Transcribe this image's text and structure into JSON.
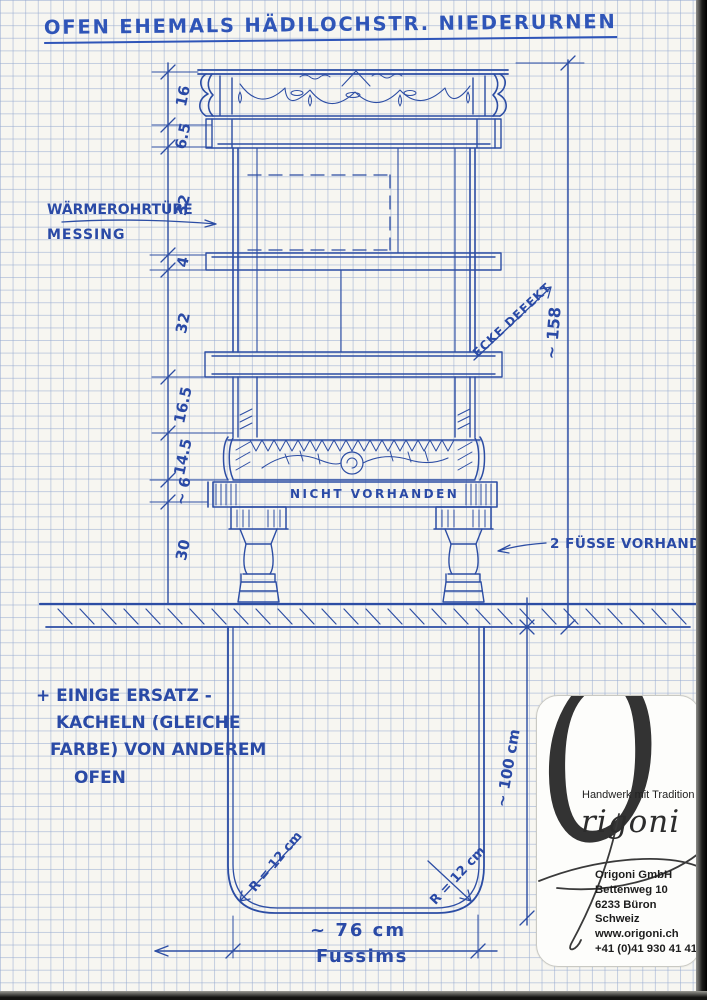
{
  "title": "OFEN EHEMALS HÄDILOCHSTR. NIEDERURNEN",
  "labels": {
    "door_line1": "WÄRMEROHRTÜRE",
    "door_line2": "MESSING",
    "corner_defect": "ECKE DEFEKT",
    "not_present": "NICHT VORHANDEN",
    "feet": "2 FÜSSE VORHANDEN",
    "note1": "+ EINIGE ERSATZ -",
    "note2": "KACHELN (GLEICHE",
    "note3": "FARBE) VON ANDEREM",
    "note4": "OFEN",
    "radius_left": "R = 12 cm",
    "radius_right": "R = 12 cm",
    "width": "~ 76 cm",
    "width_name": "Fussims",
    "depth": "~ 100 cm",
    "total_height": "~ 158"
  },
  "dimensions_left": [
    "16",
    "6.5",
    "32",
    "4",
    "32",
    "16.5",
    "14.5",
    "~ 6",
    "30"
  ],
  "stamp": {
    "brand_initial": "O",
    "brand_rest": "rigoni",
    "tagline": "Handwerk mit Tradition",
    "company": "Origoni GmbH",
    "street": "Bettenweg 10",
    "city": "6233 Büron",
    "country": "Schweiz",
    "website": "www.origoni.ch",
    "phone": "+41 (0)41 930 41 41"
  },
  "colors": {
    "ink": "#2c4da4",
    "grid": "#c9d3e6",
    "paper": "#f7f6f1"
  }
}
